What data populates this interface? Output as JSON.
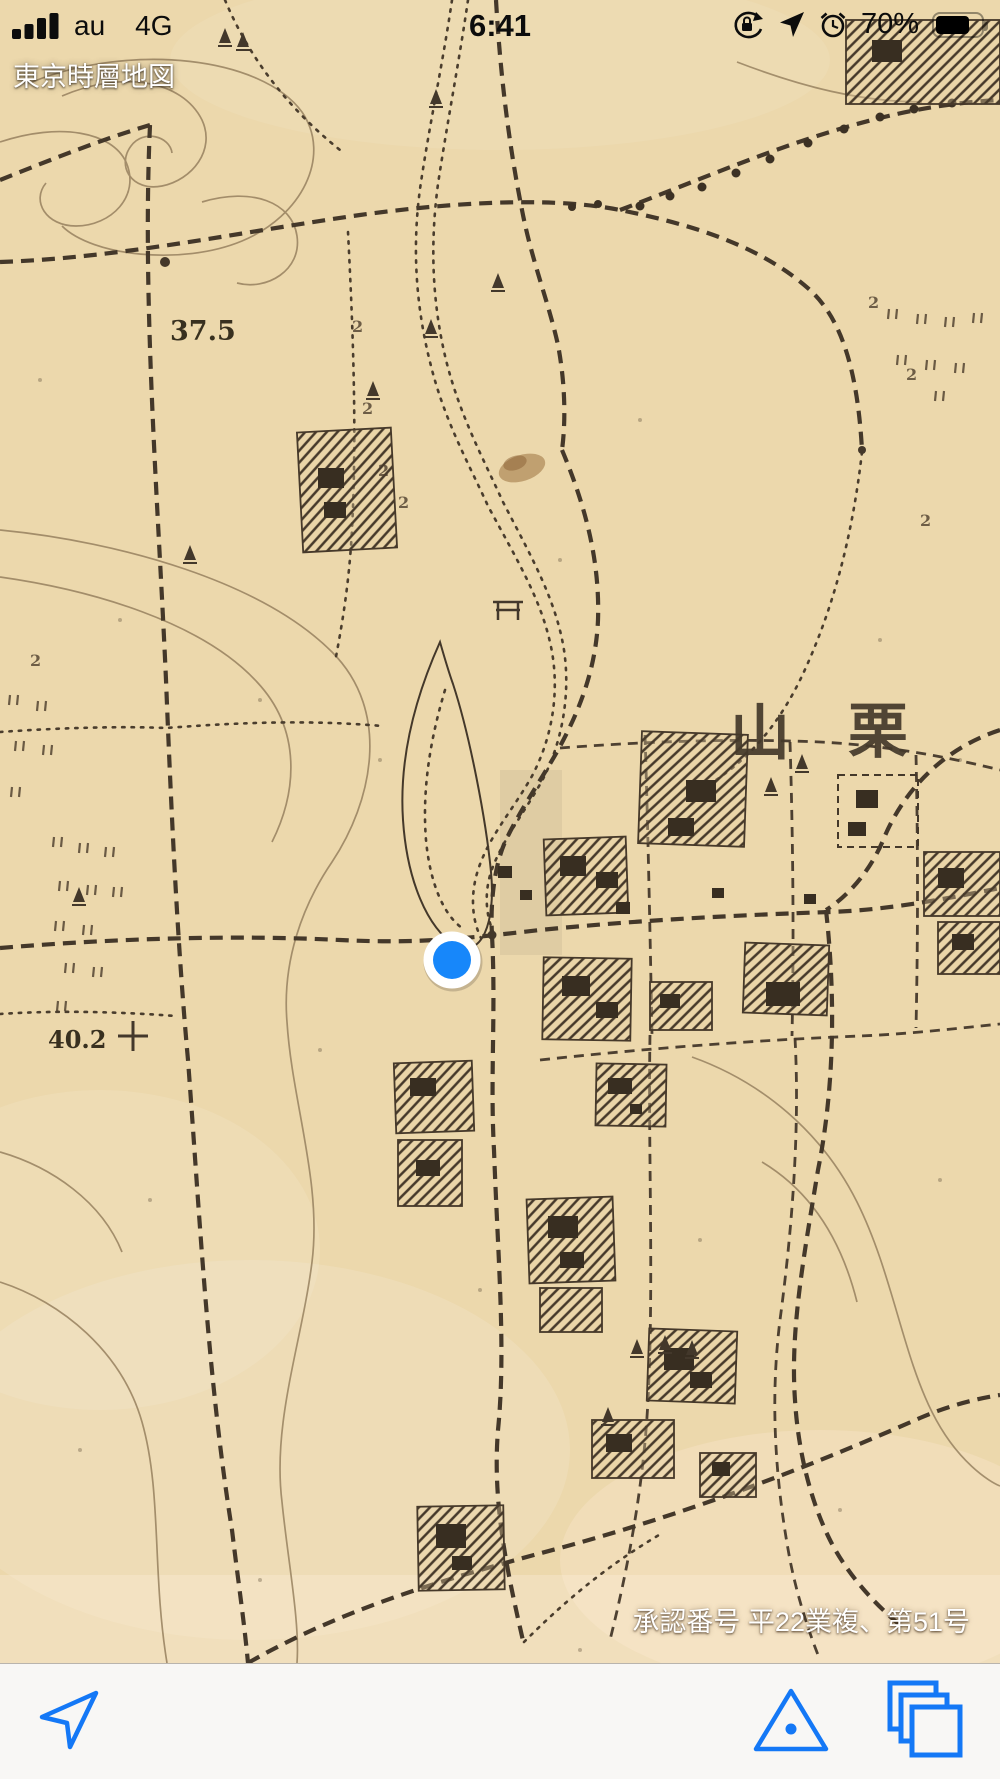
{
  "status_bar": {
    "carrier": "au",
    "network": "4G",
    "time": "6:41",
    "battery_percent": "70%"
  },
  "overlay": {
    "app_title": "東京時層地図",
    "approval_text": "承認番号 平22業複、第51号"
  },
  "map": {
    "labels": {
      "elevation_a": "37.5",
      "elevation_b": "40.2",
      "place_char_left": "山",
      "place_char_right": "栗",
      "field_mark": "2"
    },
    "colors": {
      "paper": "#ecd8ac",
      "ink": "#44382a",
      "contour": "#97815f",
      "location_dot": "#1787fa",
      "toolbar_accent": "#1478f6"
    }
  },
  "toolbar": {
    "buttons": [
      {
        "name": "location-arrow-button",
        "icon": "location-arrow-icon"
      },
      {
        "name": "triangulation-point-button",
        "icon": "triangle-dot-icon"
      },
      {
        "name": "layers-button",
        "icon": "stacked-squares-icon"
      }
    ]
  }
}
